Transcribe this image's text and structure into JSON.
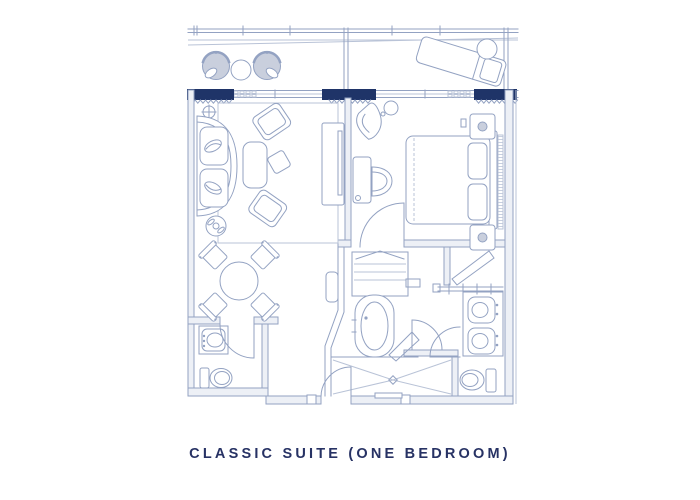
{
  "caption": {
    "text": "CLASSIC SUITE (ONE BEDROOM)"
  },
  "colors": {
    "line": "#93a2c2",
    "line-light": "#b9c3d7",
    "wall-fill": "#edf0f6",
    "furniture-gray": "#c9cfdd",
    "navy": "#1f3468",
    "caption-text": "#273264",
    "background": "#ffffff"
  },
  "floorplan": {
    "areas": [
      "balcony",
      "living-room",
      "dining-area",
      "bedroom",
      "entry",
      "powder-room",
      "closet",
      "bathroom",
      "water-closet",
      "vanity-area"
    ],
    "furniture": [
      "lounge-chair",
      "round-table",
      "chaise-lounge",
      "sofa",
      "armchair",
      "coffee-table",
      "side-table",
      "tv-console",
      "desk",
      "desk-chair",
      "reading-chair",
      "king-bed",
      "nightstand",
      "table-lamp",
      "dining-table",
      "dining-chair",
      "wardrobe-shelves",
      "luggage-rack",
      "bathtub",
      "shower",
      "shower-bench",
      "double-vanity-sink",
      "toilet",
      "powder-vanity",
      "door-threshold",
      "window",
      "railing"
    ]
  }
}
